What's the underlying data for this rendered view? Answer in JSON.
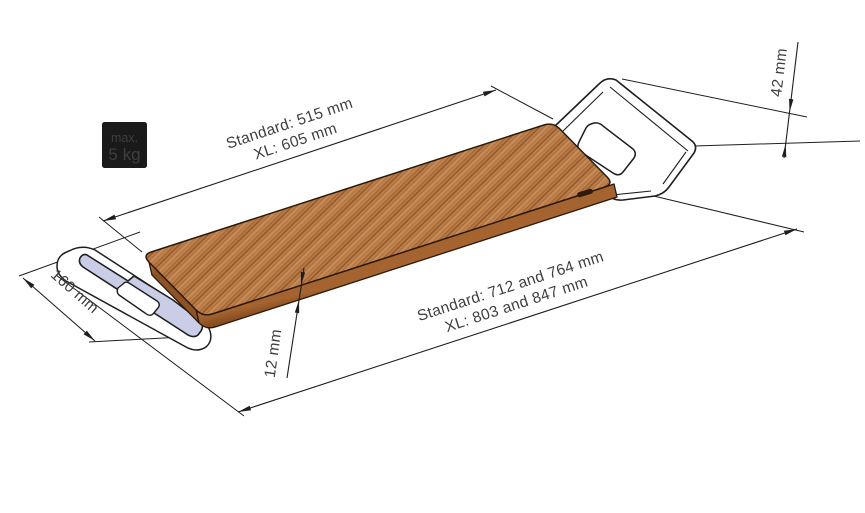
{
  "figure": {
    "type": "technical-drawing",
    "subject": "bath board with two tub-mounting brackets, isometric view with dimensions",
    "badge": {
      "line1": "max.",
      "line2": "5 kg"
    },
    "dimensions": {
      "board_length": {
        "line1": "Standard: 515 mm",
        "line2": "XL: 605 mm"
      },
      "overall_length": {
        "line1": "Standard: 712 and 764 mm",
        "line2": "XL: 803 and 847 mm"
      },
      "bracket_width": "160 mm",
      "board_thickness": "12 mm",
      "bracket_hook_height": "42 mm"
    },
    "colors": {
      "background": "#ffffff",
      "line": "#1f1f1f",
      "text": "#3f3f3f",
      "badge_bg": "#1a1a1a",
      "badge_text": "#ffffff",
      "wood_mid": "#b4743f",
      "wood_dark": "#8f5224",
      "wood_light": "#c98f5c",
      "wood_front_top": "#a4632f",
      "wood_front_bottom": "#7c441c",
      "bracket_fill": "#c9cee6",
      "bracket_outline": "#1f1f1f"
    }
  }
}
